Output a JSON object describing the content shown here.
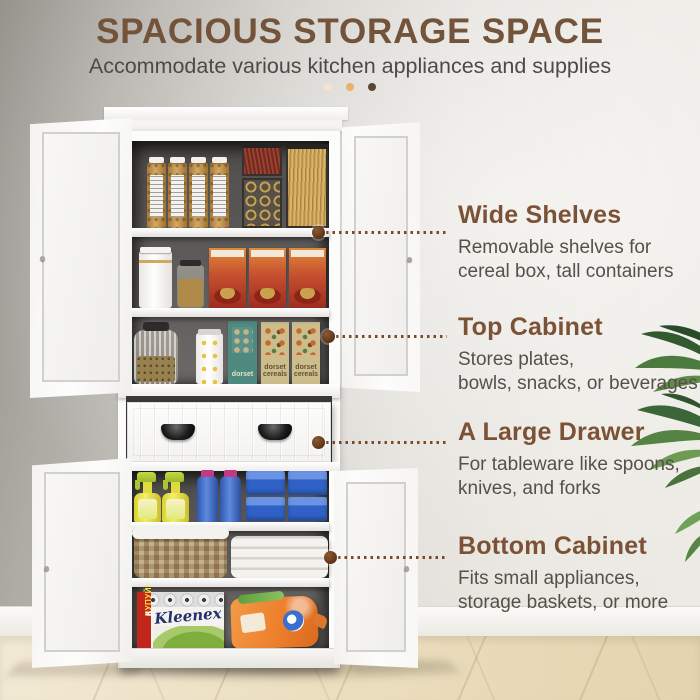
{
  "header": {
    "title": "SPACIOUS STORAGE SPACE",
    "subtitle": "Accommodate various kitchen appliances and supplies",
    "accent_dots": [
      {
        "name": "dot-cream",
        "color": "#f2e4d0"
      },
      {
        "name": "dot-orange",
        "color": "#edb069"
      },
      {
        "name": "dot-brown",
        "color": "#5a4636"
      }
    ]
  },
  "callouts": [
    {
      "title": "Wide Shelves",
      "line1": "Removable shelves for",
      "line2": "cereal box, tall containers"
    },
    {
      "title": "Top Cabinet",
      "line1": "Stores plates,",
      "line2": "bowls, snacks, or beverages"
    },
    {
      "title": "A Large Drawer",
      "line1": "For tableware like spoons,",
      "line2": "knives, and forks"
    },
    {
      "title": "Bottom Cabinet",
      "line1": "Fits small appliances,",
      "line2": "storage baskets, or more"
    }
  ],
  "labels": {
    "kleenex": "Kleenex",
    "dorset1": "dorset",
    "dorset2": "cereals",
    "promo_main": "КУПУЙ!",
    "promo_8": "8",
    "promo_6": "6"
  },
  "cabinet": {
    "style": "white 4-door pantry with center drawer, all doors open",
    "contents": {
      "top_shelf": [
        "snack-jar",
        "snack-jar",
        "snack-jar",
        "snack-jar",
        "clear-box-red-sticks",
        "clear-box-gold-rings",
        "spaghetti-container"
      ],
      "second_shelf": [
        "white-canister",
        "glass-jar",
        "cereal-box-red",
        "cereal-box-red",
        "cereal-box-red"
      ],
      "third_shelf": [
        "ribbed-glass-jar-seeds",
        "white-can",
        "teal-cereal-box",
        "khaki-cereal-box",
        "khaki-cereal-box"
      ],
      "fourth_shelf": [
        "spray-bottle",
        "spray-bottle",
        "blue-bottle",
        "blue-bottle",
        "blue-box-stack",
        "blue-box-stack"
      ],
      "fifth_shelf": [
        "wicker-basket",
        "folded-linens"
      ],
      "bottom_shelf": [
        "kleenex-paper-towel-pack",
        "orange-detergent-bag"
      ]
    }
  },
  "colors": {
    "title_brown": "#73543a",
    "heading_brown": "#7b5236",
    "body_text": "#55504a",
    "dotted_line": "#79492a",
    "marker": "#5d3317",
    "wall_left": "#96928c",
    "wall_right": "#eceae4",
    "floor_wood": "#ecdfc0",
    "cabinet_white": "#fcfcfb",
    "cabinet_interior": "#5c5a58"
  },
  "icons": {
    "callout_markers": "brown-circle-dot with dotted leader line",
    "plant": "green palm leaves at right edge"
  }
}
